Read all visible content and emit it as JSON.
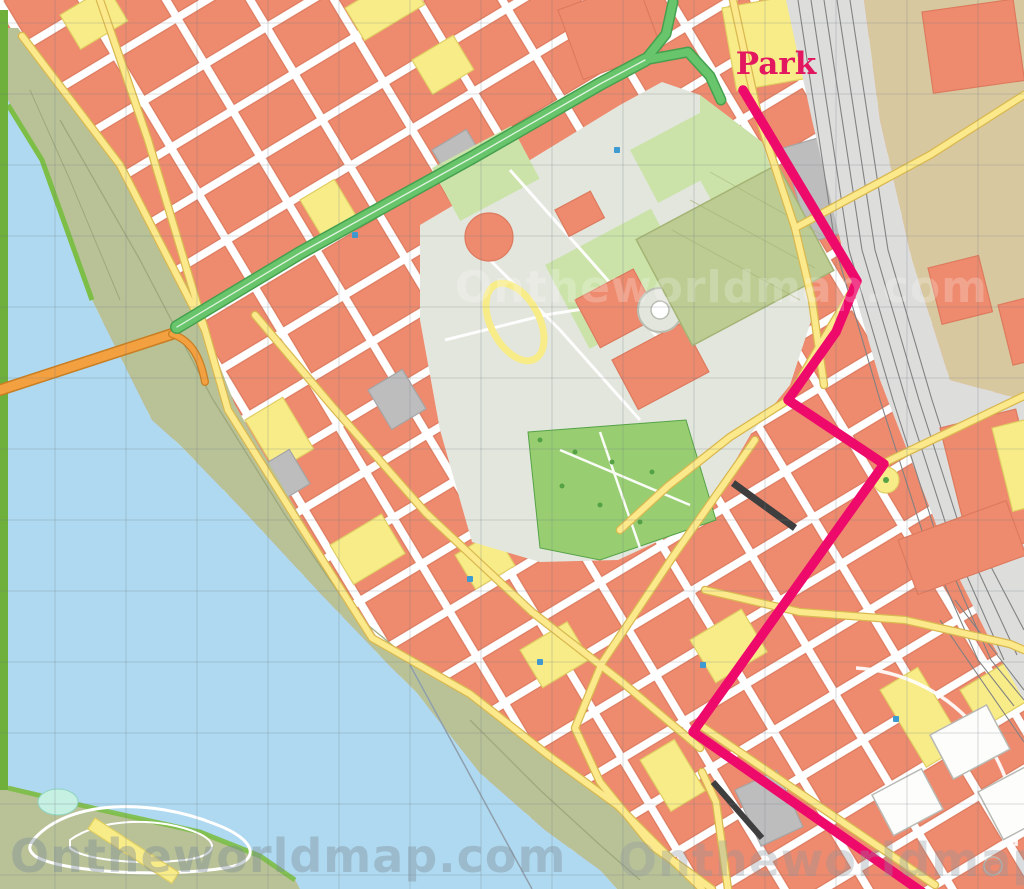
{
  "page": {
    "park_label": "Park",
    "watermark_text": "Ontheworldmap.com"
  },
  "colors": {
    "base": "#E7E6E3",
    "street_white": "#FFFFFF",
    "building_salmon": "#EE8A6E",
    "building_salmon_stroke": "#DD7A5E",
    "building_yellow": "#F8EC89",
    "building_yellow_stroke": "#E0CE62",
    "building_gray": "#BDBDBD",
    "building_gray_stroke": "#A5A5A5",
    "building_white": "#FDFDFB",
    "building_white_stroke": "#B9B9B4",
    "water": "#AFD9F0",
    "bank_olive": "#B9C297",
    "bank_trail": "#9AA578",
    "shore_green": "#7CBE46",
    "edge_green": "#6FAF3B",
    "pond_teal": "#C6F0E2",
    "park_pale": "#E3E6DD",
    "park_light": "#CBE3A9",
    "lawn_green": "#98CE71",
    "olive_block": "#BCCC92",
    "olive_block_stroke": "#A5B475",
    "tan_rail": "#D8C8A0",
    "rail_gray": "#DDDDDC",
    "track": "#828282",
    "road_yellow": "#FBE98C",
    "road_casing": "#D9B850",
    "bridge_orange": "#F3A041",
    "bridge_casing": "#C87E22",
    "dark_road": "#3E3E3E",
    "route_pink": "#EE0A6B",
    "route_green": "#69C56B",
    "route_green_casing": "#45A04F",
    "label_pink": "#E2175F",
    "grid": "#6E7A85",
    "poi_blue": "#3D9BD1",
    "tree_green": "#55A246"
  },
  "routes": {
    "pink": [
      [
        743,
        90
      ],
      [
        857,
        281
      ],
      [
        836,
        332
      ],
      [
        788,
        400
      ],
      [
        884,
        464
      ],
      [
        693,
        732
      ],
      [
        922,
        892
      ]
    ],
    "green_main": [
      [
        177,
        327
      ],
      [
        300,
        253
      ],
      [
        473,
        157
      ],
      [
        600,
        84
      ],
      [
        645,
        60
      ]
    ],
    "green_branch_up": [
      [
        645,
        60
      ],
      [
        666,
        34
      ],
      [
        673,
        2
      ]
    ],
    "green_branch_right": [
      [
        645,
        60
      ],
      [
        688,
        52
      ],
      [
        710,
        76
      ],
      [
        721,
        100
      ]
    ]
  },
  "grid": {
    "x0": 55,
    "y0": 23,
    "step": 71
  },
  "watermarks": [
    {
      "x": 10,
      "y": 872,
      "fill": "#7E8C99",
      "opacity": 0.4,
      "size": 46
    },
    {
      "x": 618,
      "y": 876,
      "fill": "#8D979F",
      "opacity": 0.33,
      "size": 46
    },
    {
      "x": 455,
      "y": 302,
      "fill": "#FFFFFF",
      "opacity": 0.22,
      "size": 44
    }
  ]
}
